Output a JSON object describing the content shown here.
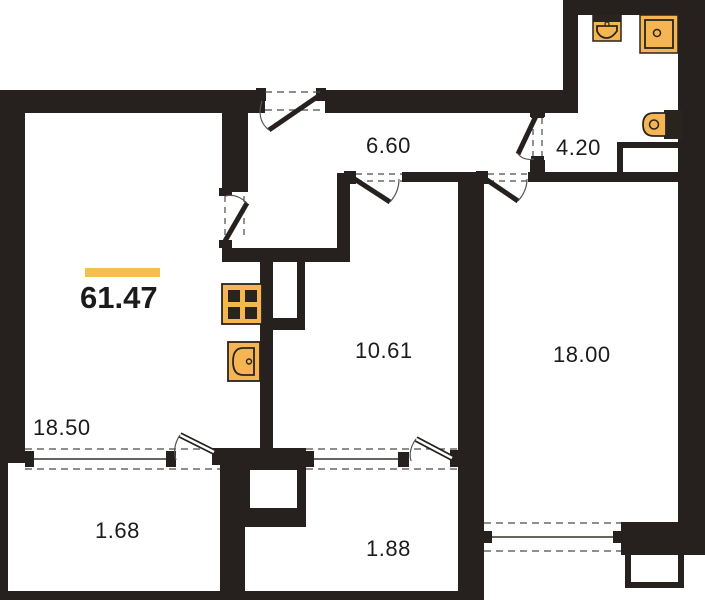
{
  "plan": {
    "title": "apartment-floor-plan",
    "total_area": {
      "value": "61.47",
      "accent_bar_color": "#f2c050"
    },
    "rooms": [
      {
        "id": "hallway",
        "area": "6.60"
      },
      {
        "id": "bathroom",
        "area": "4.20"
      },
      {
        "id": "kitchen",
        "area": "10.61"
      },
      {
        "id": "bedroom",
        "area": "18.00"
      },
      {
        "id": "living-kitchen",
        "area": "18.50"
      },
      {
        "id": "balcony-left",
        "area": "1.68"
      },
      {
        "id": "balcony-right",
        "area": "1.88"
      }
    ],
    "fixtures": [
      "washbasin-icon",
      "shower-icon",
      "toilet-icon",
      "stove-icon",
      "kitchen-sink-icon"
    ],
    "colors": {
      "wall": "#26211e",
      "fixture_fill": "#f6b553",
      "fixture_stroke": "#2a241f",
      "dash": "#4a4a4a",
      "text": "#1b1b1b"
    }
  }
}
